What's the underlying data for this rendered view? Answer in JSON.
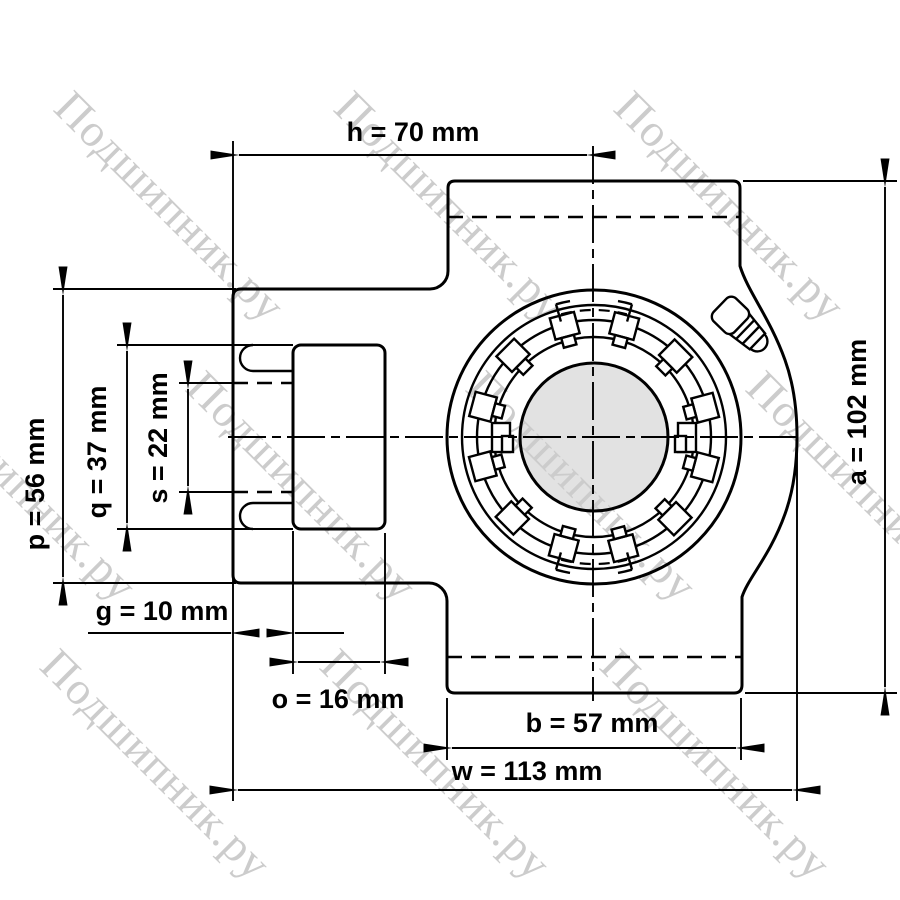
{
  "watermark": {
    "text": "Подшипник.ру",
    "color": "#cccccc"
  },
  "drawing": {
    "background": "#ffffff",
    "line_color": "#000000",
    "shaft_fill": "#e2e2e2"
  },
  "dimensions": {
    "h": {
      "label": "h = 70 mm",
      "value": 70,
      "unit": "mm"
    },
    "a": {
      "label": "a = 102 mm",
      "value": 102,
      "unit": "mm"
    },
    "p": {
      "label": "p = 56 mm",
      "value": 56,
      "unit": "mm"
    },
    "q": {
      "label": "q = 37 mm",
      "value": 37,
      "unit": "mm"
    },
    "s": {
      "label": "s = 22 mm",
      "value": 22,
      "unit": "mm"
    },
    "g": {
      "label": "g = 10 mm",
      "value": 10,
      "unit": "mm"
    },
    "o": {
      "label": "o = 16 mm",
      "value": 16,
      "unit": "mm"
    },
    "b": {
      "label": "b = 57 mm",
      "value": 57,
      "unit": "mm"
    },
    "w": {
      "label": "w = 113 mm",
      "value": 113,
      "unit": "mm"
    }
  }
}
